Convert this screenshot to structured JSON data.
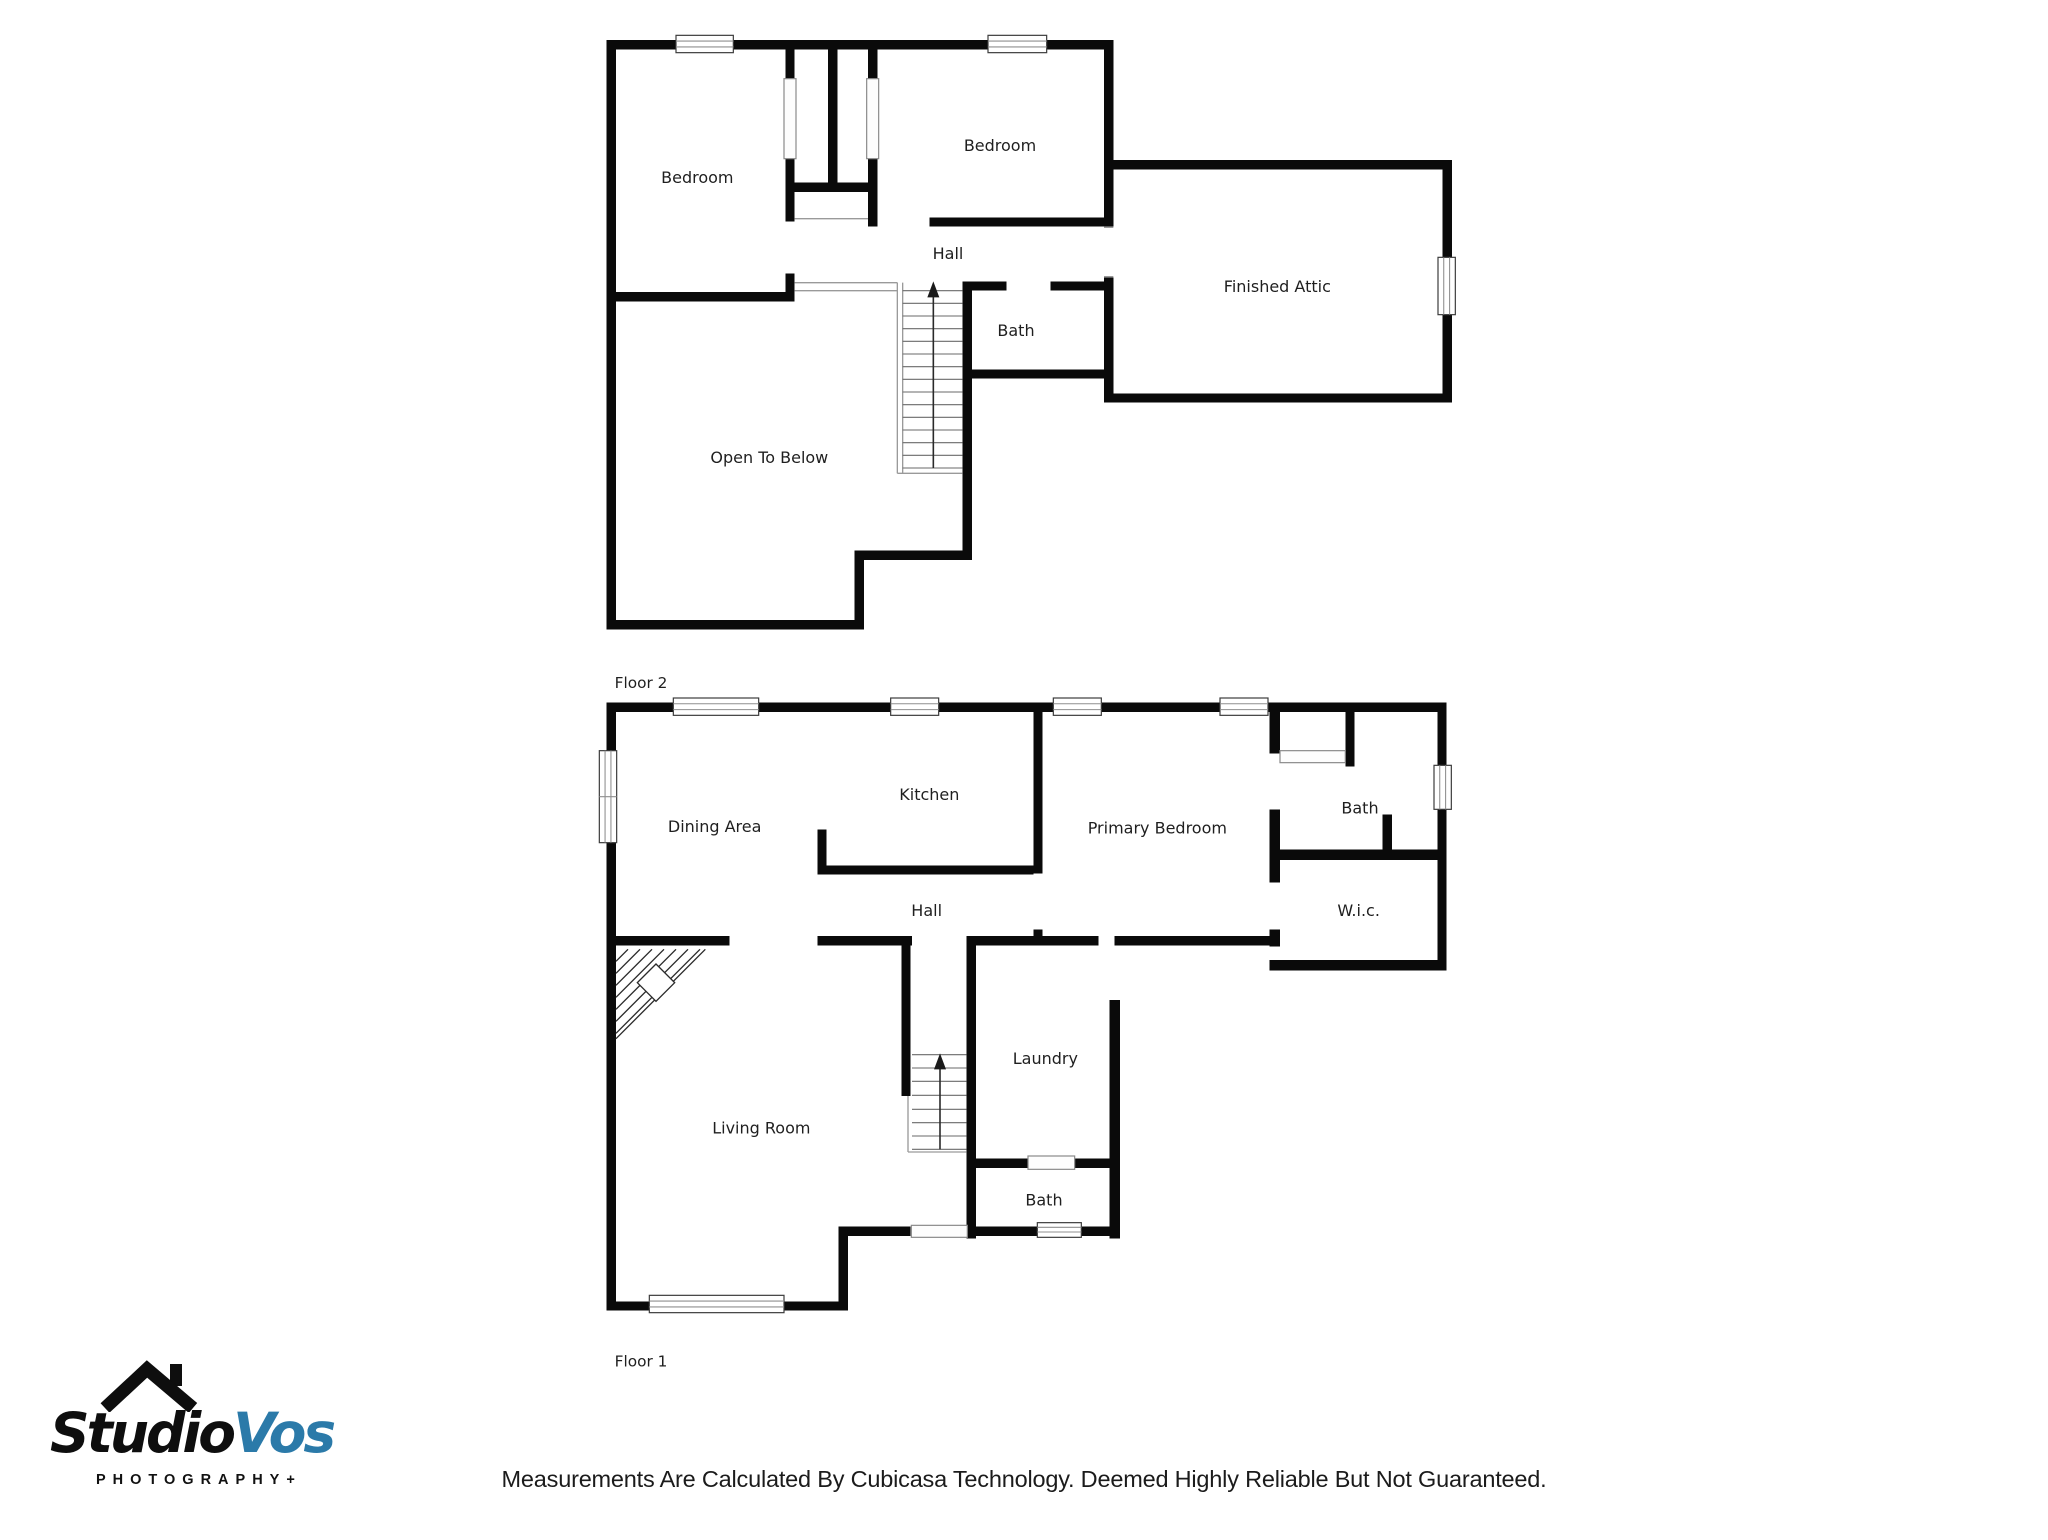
{
  "page": {
    "background": "#ffffff"
  },
  "floors": [
    {
      "label": "Floor 2",
      "rooms": [
        {
          "name": "Bedroom"
        },
        {
          "name": "Bedroom"
        },
        {
          "name": "Hall"
        },
        {
          "name": "Bath"
        },
        {
          "name": "Open To Below"
        },
        {
          "name": "Finished Attic"
        }
      ]
    },
    {
      "label": "Floor 1",
      "rooms": [
        {
          "name": "Dining Area"
        },
        {
          "name": "Kitchen"
        },
        {
          "name": "Primary Bedroom"
        },
        {
          "name": "Bath"
        },
        {
          "name": "W.i.c."
        },
        {
          "name": "Hall"
        },
        {
          "name": "Living Room"
        },
        {
          "name": "Laundry"
        },
        {
          "name": "Bath"
        }
      ]
    }
  ],
  "logo": {
    "brand_part1": "Studio",
    "brand_part2": "Vos",
    "tagline": "PHOTOGRAPHY+",
    "colors": {
      "brand_black": "#0e0e0e",
      "brand_blue": "#2b7aa9"
    }
  },
  "footer": {
    "disclaimer": "Measurements Are Calculated By Cubicasa Technology. Deemed Highly Reliable But Not Guaranteed."
  }
}
